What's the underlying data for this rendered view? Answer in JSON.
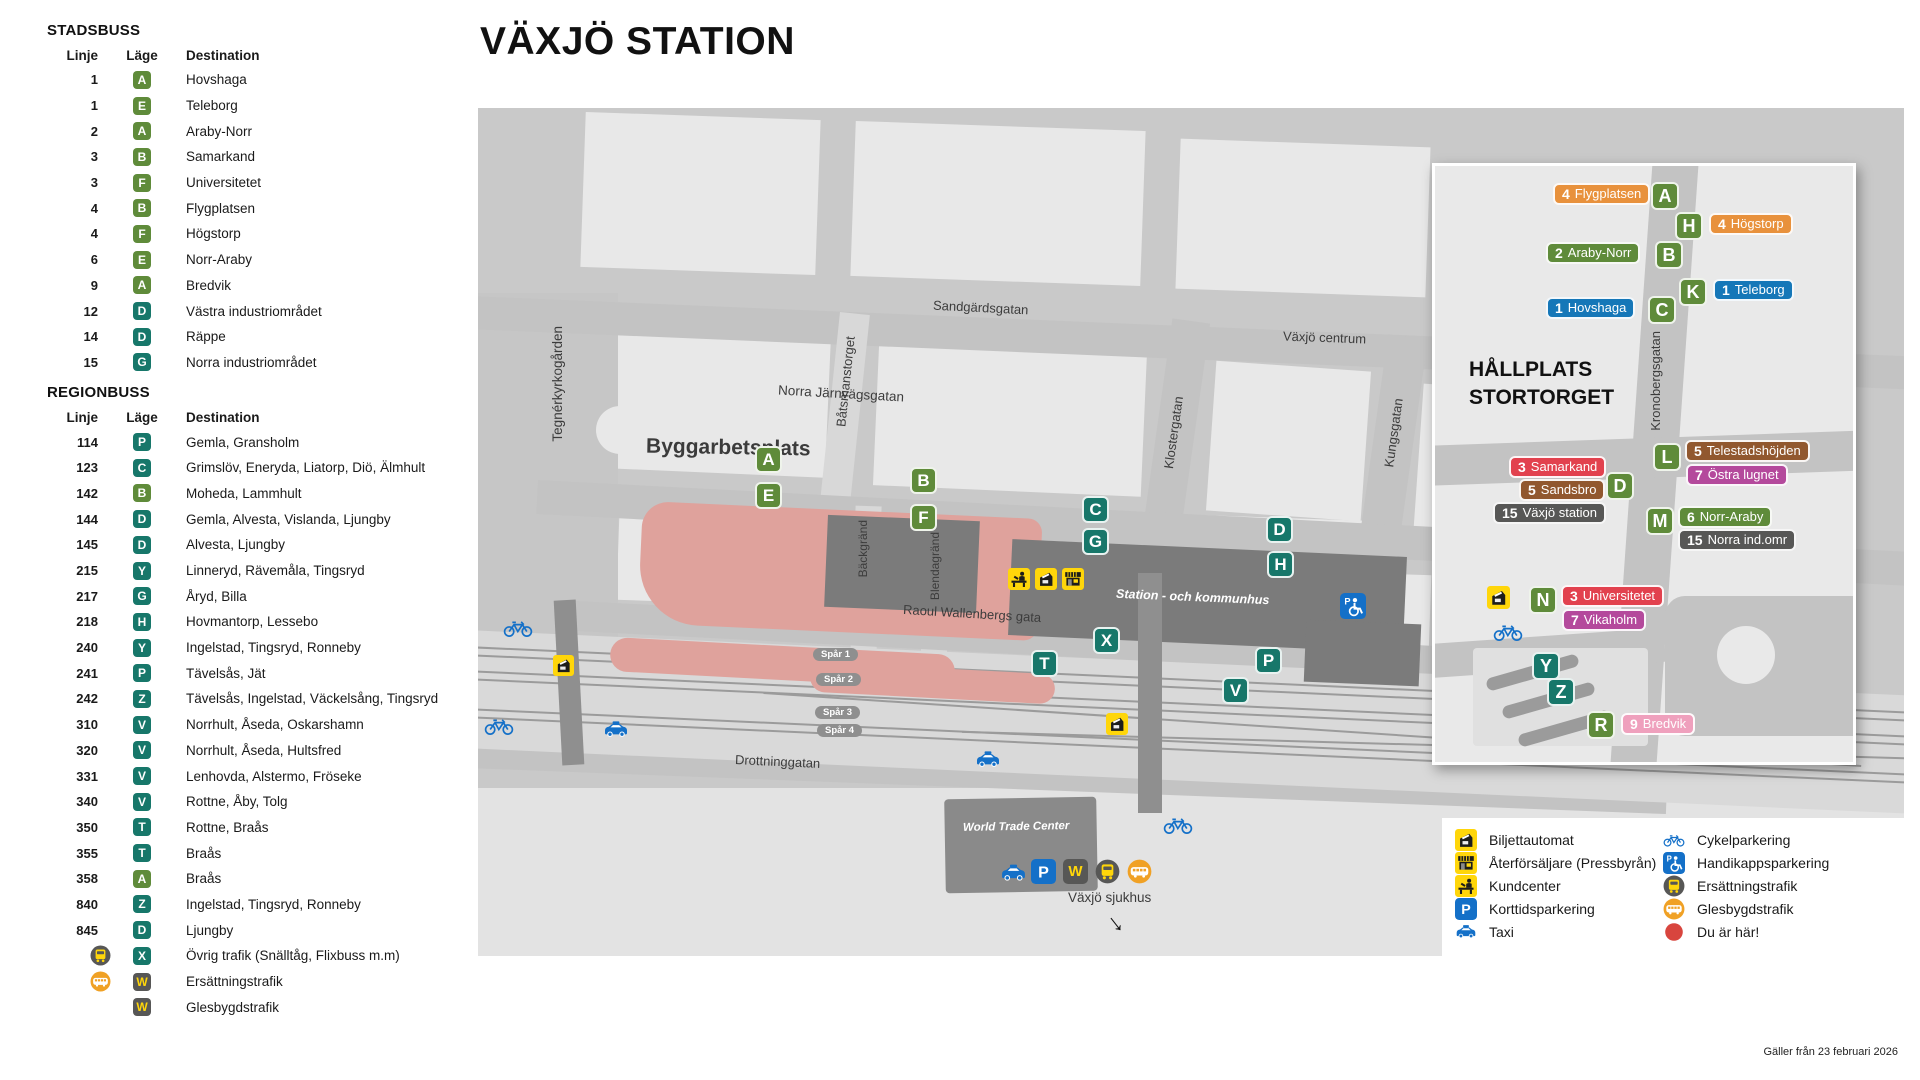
{
  "title": "VÄXJÖ STATION",
  "footer": "Gäller från 23 februari 2026",
  "palette": {
    "stadsbuss_green": "#5f8b3a",
    "regionbuss_teal": "#17776a",
    "badge_dark": "#575756",
    "label_orange": "#e8913c",
    "label_blue": "#1577b8",
    "label_red": "#e2414e",
    "label_brown": "#91582f",
    "label_gray": "#575756",
    "label_magenta": "#b4499c",
    "label_pink": "#efa0bd",
    "icon_yellow": "#ffd60a",
    "icon_blue": "#1470c8",
    "circle_orange": "#f0a125",
    "you_are_here_red": "#d8453e",
    "construction_pink": "#dfa29c"
  },
  "sidebar": {
    "stadsbuss": {
      "heading": "STADSBUSS",
      "columns": {
        "linje": "Linje",
        "lage": "Läge",
        "destination": "Destination"
      },
      "rows": [
        {
          "linje": "1",
          "lage": "A",
          "lageColor": "green",
          "icon": "",
          "destination": "Hovshaga"
        },
        {
          "linje": "1",
          "lage": "E",
          "lageColor": "green",
          "icon": "",
          "destination": "Teleborg"
        },
        {
          "linje": "2",
          "lage": "A",
          "lageColor": "green",
          "icon": "",
          "destination": "Araby-Norr"
        },
        {
          "linje": "3",
          "lage": "B",
          "lageColor": "green",
          "icon": "",
          "destination": "Samarkand"
        },
        {
          "linje": "3",
          "lage": "F",
          "lageColor": "green",
          "icon": "",
          "destination": "Universitetet"
        },
        {
          "linje": "4",
          "lage": "B",
          "lageColor": "green",
          "icon": "",
          "destination": "Flygplatsen"
        },
        {
          "linje": "4",
          "lage": "F",
          "lageColor": "green",
          "icon": "",
          "destination": "Högstorp"
        },
        {
          "linje": "6",
          "lage": "E",
          "lageColor": "green",
          "icon": "",
          "destination": "Norr-Araby"
        },
        {
          "linje": "9",
          "lage": "A",
          "lageColor": "green",
          "icon": "",
          "destination": "Bredvik"
        },
        {
          "linje": "12",
          "lage": "D",
          "lageColor": "teal",
          "icon": "",
          "destination": "Västra industriområdet"
        },
        {
          "linje": "14",
          "lage": "D",
          "lageColor": "teal",
          "icon": "",
          "destination": "Räppe"
        },
        {
          "linje": "15",
          "lage": "G",
          "lageColor": "teal",
          "icon": "",
          "destination": "Norra industriområdet"
        }
      ]
    },
    "regionbuss": {
      "heading": "REGIONBUSS",
      "columns": {
        "linje": "Linje",
        "lage": "Läge",
        "destination": "Destination"
      },
      "rows": [
        {
          "linje": "114",
          "lage": "P",
          "lageColor": "teal",
          "icon": "",
          "destination": "Gemla, Gransholm"
        },
        {
          "linje": "123",
          "lage": "C",
          "lageColor": "teal",
          "icon": "",
          "destination": "Grimslöv, Eneryda, Liatorp, Diö, Älmhult"
        },
        {
          "linje": "142",
          "lage": "B",
          "lageColor": "green",
          "icon": "",
          "destination": "Moheda, Lammhult"
        },
        {
          "linje": "144",
          "lage": "D",
          "lageColor": "teal",
          "icon": "",
          "destination": "Gemla, Alvesta, Vislanda, Ljungby"
        },
        {
          "linje": "145",
          "lage": "D",
          "lageColor": "teal",
          "icon": "",
          "destination": "Alvesta, Ljungby"
        },
        {
          "linje": "215",
          "lage": "Y",
          "lageColor": "teal",
          "icon": "",
          "destination": "Linneryd, Rävemåla, Tingsryd"
        },
        {
          "linje": "217",
          "lage": "G",
          "lageColor": "teal",
          "icon": "",
          "destination": "Åryd, Billa"
        },
        {
          "linje": "218",
          "lage": "H",
          "lageColor": "teal",
          "icon": "",
          "destination": "Hovmantorp, Lessebo"
        },
        {
          "linje": "240",
          "lage": "Y",
          "lageColor": "teal",
          "icon": "",
          "destination": "Ingelstad, Tingsryd, Ronneby"
        },
        {
          "linje": "241",
          "lage": "P",
          "lageColor": "teal",
          "icon": "",
          "destination": "Tävelsås, Jät"
        },
        {
          "linje": "242",
          "lage": "Z",
          "lageColor": "teal",
          "icon": "",
          "destination": "Tävelsås, Ingelstad, Väckelsång, Tingsryd"
        },
        {
          "linje": "310",
          "lage": "V",
          "lageColor": "teal",
          "icon": "",
          "destination": "Norrhult, Åseda, Oskarshamn"
        },
        {
          "linje": "320",
          "lage": "V",
          "lageColor": "teal",
          "icon": "",
          "destination": "Norrhult, Åseda, Hultsfred"
        },
        {
          "linje": "331",
          "lage": "V",
          "lageColor": "teal",
          "icon": "",
          "destination": "Lenhovda, Alstermo, Fröseke"
        },
        {
          "linje": "340",
          "lage": "V",
          "lageColor": "teal",
          "icon": "",
          "destination": "Rottne, Åby, Tolg"
        },
        {
          "linje": "350",
          "lage": "T",
          "lageColor": "teal",
          "icon": "",
          "destination": "Rottne, Braås"
        },
        {
          "linje": "355",
          "lage": "T",
          "lageColor": "teal",
          "icon": "",
          "destination": "Braås"
        },
        {
          "linje": "358",
          "lage": "A",
          "lageColor": "green",
          "icon": "",
          "destination": "Braås"
        },
        {
          "linje": "840",
          "lage": "Z",
          "lageColor": "teal",
          "icon": "",
          "destination": "Ingelstad, Tingsryd, Ronneby"
        },
        {
          "linje": "845",
          "lage": "D",
          "lageColor": "teal",
          "icon": "",
          "destination": "Ljungby"
        },
        {
          "linje": "",
          "lage": "X",
          "lageColor": "teal",
          "icon": "bus-dark",
          "destination": "Övrig trafik (Snälltåg, Flixbuss m.m)"
        },
        {
          "linje": "",
          "lage": "W",
          "lageColor": "dark",
          "icon": "bus-orange",
          "destination": "Ersättningstrafik"
        },
        {
          "linje": "",
          "lage": "W",
          "lageColor": "dark",
          "icon": "",
          "destination": "Glesbygdstrafik"
        }
      ]
    }
  },
  "map": {
    "streets": {
      "sandgardsgatan": "Sandgärdsgatan",
      "vaxjo_centrum": "Växjö centrum",
      "batsmanstorget": "Båtsmanstorget",
      "klostergatan": "Klostergatan",
      "kungsgatan": "Kungsgatan",
      "norra_jarnvagsgatan": "Norra Järnvägsgatan",
      "backgrand": "Bäckgränd",
      "blendagrand": "Blendagränd",
      "tegnerkyrkogarden": "Tegnérkyrkogården",
      "raoul_wallenbergs_gata": "Raoul Wallenbergs gata",
      "drottninggatan": "Drottninggatan"
    },
    "areas": {
      "byggarbetsplats": "Byggarbetsplats",
      "station_kommunhus": "Station - och kommunhus",
      "world_trade_center": "World Trade Center",
      "vaxjo_sjukhus": "Växjö sjukhus"
    },
    "tracks": {
      "spar1": "Spår 1",
      "spar2": "Spår 2",
      "spar3": "Spår 3",
      "spar4": "Spår 4"
    },
    "stops": [
      {
        "letter": "A",
        "color": "green"
      },
      {
        "letter": "E",
        "color": "green"
      },
      {
        "letter": "B",
        "color": "green"
      },
      {
        "letter": "F",
        "color": "green"
      },
      {
        "letter": "C",
        "color": "teal"
      },
      {
        "letter": "G",
        "color": "teal"
      },
      {
        "letter": "D",
        "color": "teal"
      },
      {
        "letter": "H",
        "color": "teal"
      },
      {
        "letter": "X",
        "color": "teal"
      },
      {
        "letter": "T",
        "color": "teal"
      },
      {
        "letter": "P",
        "color": "teal"
      },
      {
        "letter": "V",
        "color": "teal"
      }
    ]
  },
  "inset": {
    "title_line1": "HÅLLPLATS",
    "title_line2": "STORTORGET",
    "street": "Kronobergsgatan",
    "stops": [
      {
        "letter": "A",
        "color": "green"
      },
      {
        "letter": "H",
        "color": "green"
      },
      {
        "letter": "B",
        "color": "green"
      },
      {
        "letter": "K",
        "color": "green"
      },
      {
        "letter": "C",
        "color": "green"
      },
      {
        "letter": "D",
        "color": "green"
      },
      {
        "letter": "L",
        "color": "green"
      },
      {
        "letter": "M",
        "color": "green"
      },
      {
        "letter": "N",
        "color": "green"
      },
      {
        "letter": "Y",
        "color": "teal"
      },
      {
        "letter": "Z",
        "color": "teal"
      },
      {
        "letter": "R",
        "color": "green"
      }
    ],
    "labels": [
      {
        "number": "4",
        "name": "Flygplatsen",
        "color": "orange"
      },
      {
        "number": "4",
        "name": "Högstorp",
        "color": "orange"
      },
      {
        "number": "2",
        "name": "Araby-Norr",
        "color": "green"
      },
      {
        "number": "1",
        "name": "Teleborg",
        "color": "blue"
      },
      {
        "number": "1",
        "name": "Hovshaga",
        "color": "blue"
      },
      {
        "number": "3",
        "name": "Samarkand",
        "color": "red"
      },
      {
        "number": "5",
        "name": "Sandsbro",
        "color": "brown"
      },
      {
        "number": "15",
        "name": "Växjö station",
        "color": "gray"
      },
      {
        "number": "5",
        "name": "Telestadshöjden",
        "color": "brown"
      },
      {
        "number": "7",
        "name": "Östra lugnet",
        "color": "magenta"
      },
      {
        "number": "6",
        "name": "Norr-Araby",
        "color": "green"
      },
      {
        "number": "15",
        "name": "Norra ind.omr",
        "color": "gray"
      },
      {
        "number": "3",
        "name": "Universitetet",
        "color": "red"
      },
      {
        "number": "7",
        "name": "Vikaholm",
        "color": "magenta"
      },
      {
        "number": "9",
        "name": "Bredvik",
        "color": "pink"
      }
    ]
  },
  "legend": {
    "items_left": [
      {
        "icon": "ticket-machine",
        "label": "Biljettautomat"
      },
      {
        "icon": "kiosk",
        "label": "Återförsäljare (Pressbyrån)"
      },
      {
        "icon": "counter",
        "label": "Kundcenter"
      },
      {
        "icon": "p-square",
        "label": "Korttidsparkering"
      },
      {
        "icon": "taxi",
        "label": "Taxi"
      }
    ],
    "items_right": [
      {
        "icon": "bicycle",
        "label": "Cykelparkering"
      },
      {
        "icon": "handicap-parking",
        "label": "Handikappsparkering"
      },
      {
        "icon": "bus-dark",
        "label": "Ersättningstrafik"
      },
      {
        "icon": "bus-orange",
        "label": "Glesbygdstrafik"
      },
      {
        "icon": "red-dot",
        "label": "Du är här!"
      }
    ]
  }
}
